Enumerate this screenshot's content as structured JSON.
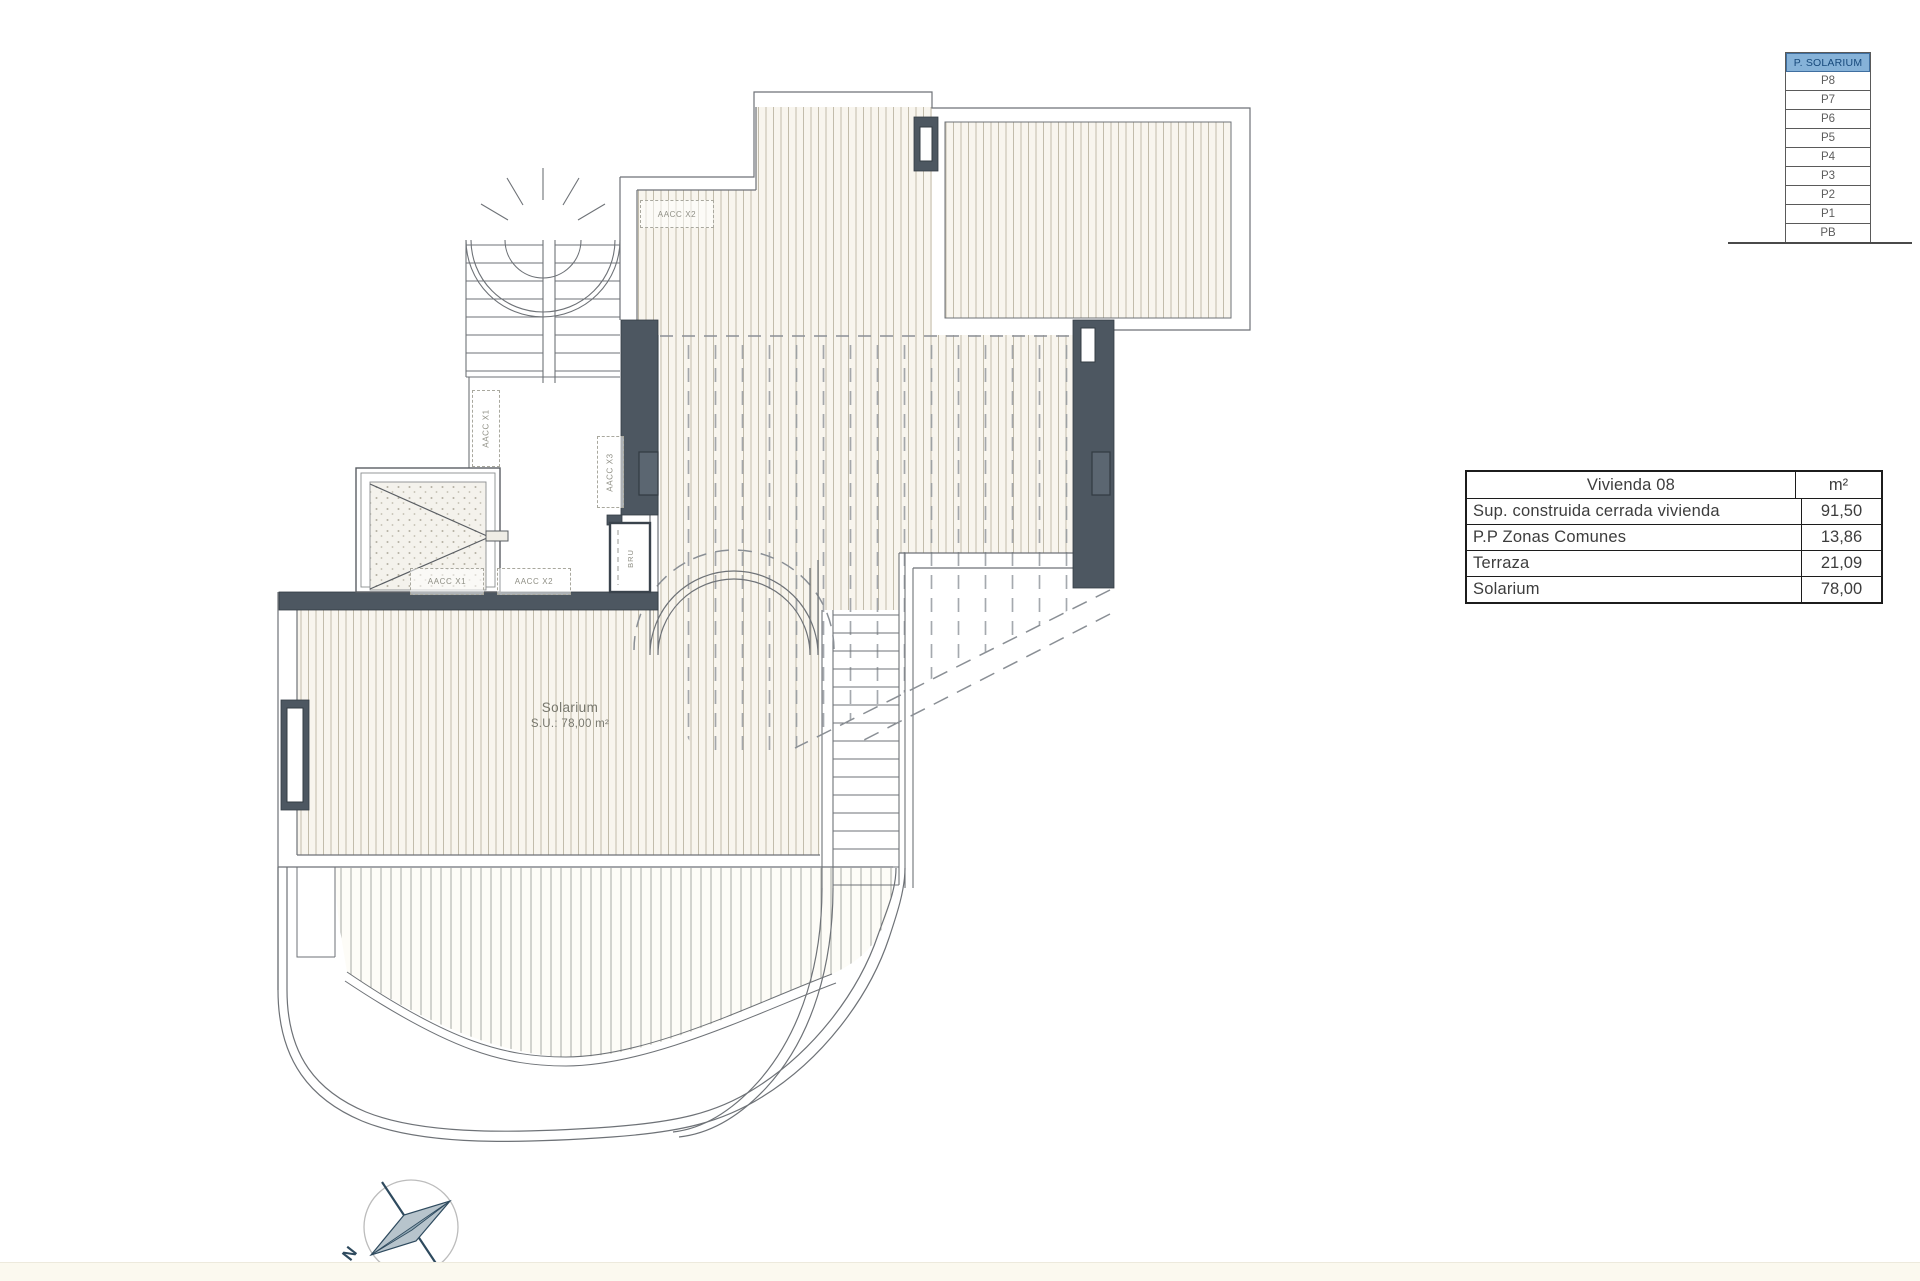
{
  "levels_panel": {
    "selected": "P. SOLARIUM",
    "floors": [
      "P8",
      "P7",
      "P6",
      "P5",
      "P4",
      "P3",
      "P2",
      "P1",
      "PB"
    ]
  },
  "areas_table": {
    "header": {
      "title": "Vivienda 08",
      "unit": "m²"
    },
    "rows": [
      {
        "label": "Sup. construida cerrada vivienda",
        "value": "91,50"
      },
      {
        "label": "P.P Zonas Comunes",
        "value": "13,86"
      },
      {
        "label": "Terraza",
        "value": "21,09"
      },
      {
        "label": "Solarium",
        "value": "78,00"
      }
    ]
  },
  "plan_labels": {
    "aacc_x2_top": "AACC X2",
    "aacc_x1_vertical": "AACC X1",
    "aacc_x3_vertical": "AACC X3",
    "aacc_x1": "AACC X1",
    "aacc_x2": "AACC X2",
    "bru": "BRU",
    "solarium_name": "Solarium",
    "solarium_area": "S.U.: 78,00 m²"
  },
  "compass": {
    "north_label": "N"
  },
  "colors": {
    "wall": "#4d5761",
    "wall_edge": "#343c44",
    "line": "#6e7277",
    "dashed": "#8a8f95",
    "hatch_line": "#c2bcab",
    "hatch_bg": "#f8f5ee",
    "header_bg": "#86b2d8",
    "header_text": "#17497b"
  }
}
